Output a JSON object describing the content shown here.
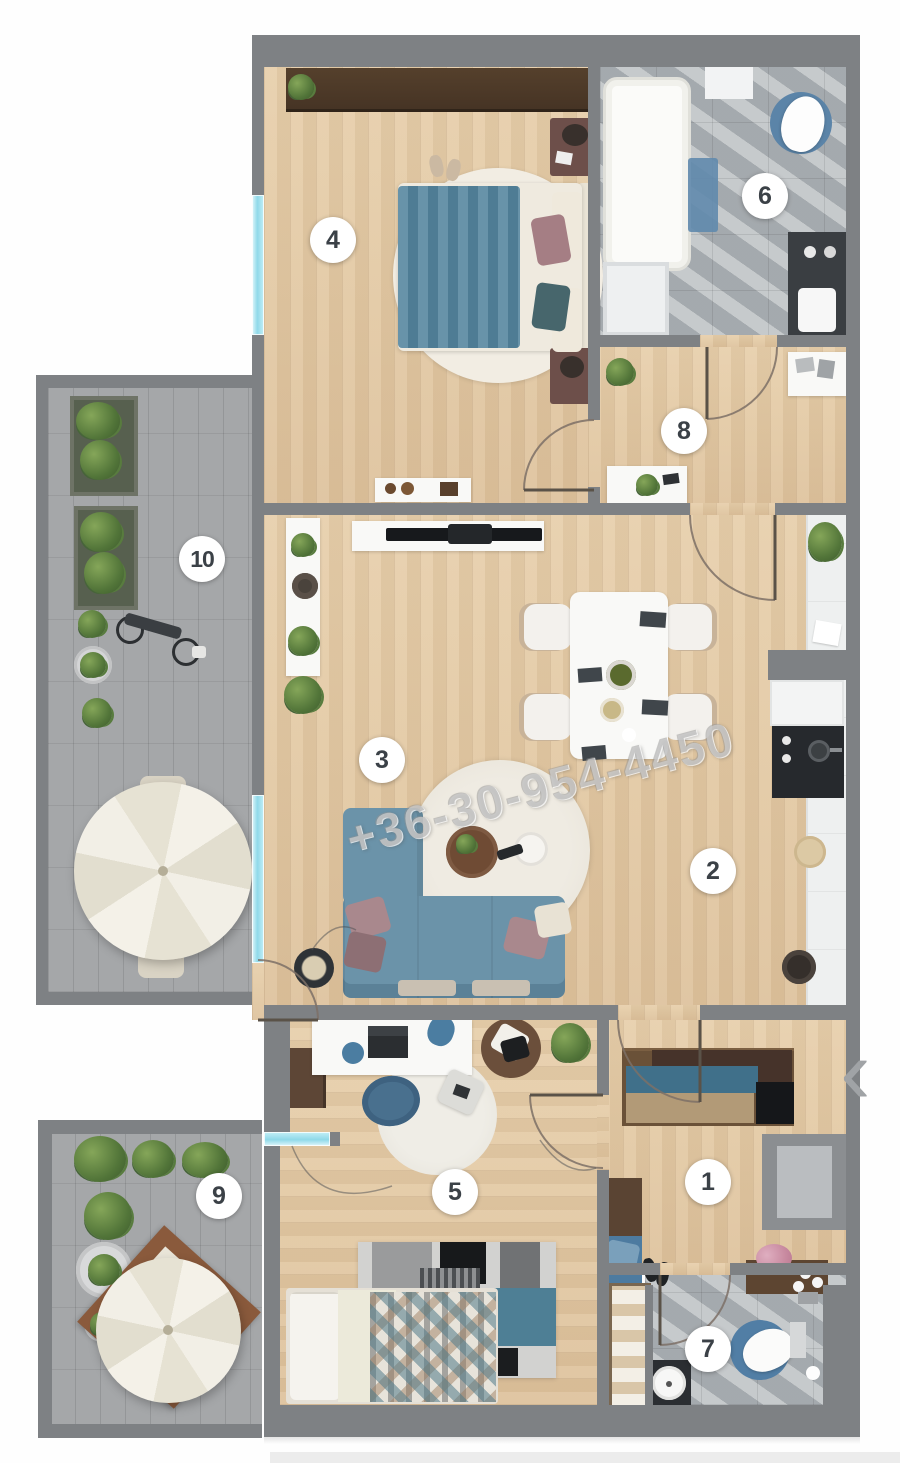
{
  "watermark": {
    "text": "+36-30-954-4450"
  },
  "nav": {
    "prev_icon": "‹"
  },
  "badges": [
    {
      "label": "1"
    },
    {
      "label": "2"
    },
    {
      "label": "3"
    },
    {
      "label": "4"
    },
    {
      "label": "5"
    },
    {
      "label": "6"
    },
    {
      "label": "7"
    },
    {
      "label": "8"
    },
    {
      "label": "9"
    },
    {
      "label": "10"
    }
  ],
  "palette": {
    "wall": "#7e8184",
    "wood": "#e4cba8",
    "tile": "#a8adb1",
    "paver": "#a5a7a9",
    "window": "#8fd9e9",
    "blue": "#57879f",
    "sofa": "#6b93a9",
    "cream": "#f2efe6",
    "wm": "#9a9a9a"
  }
}
